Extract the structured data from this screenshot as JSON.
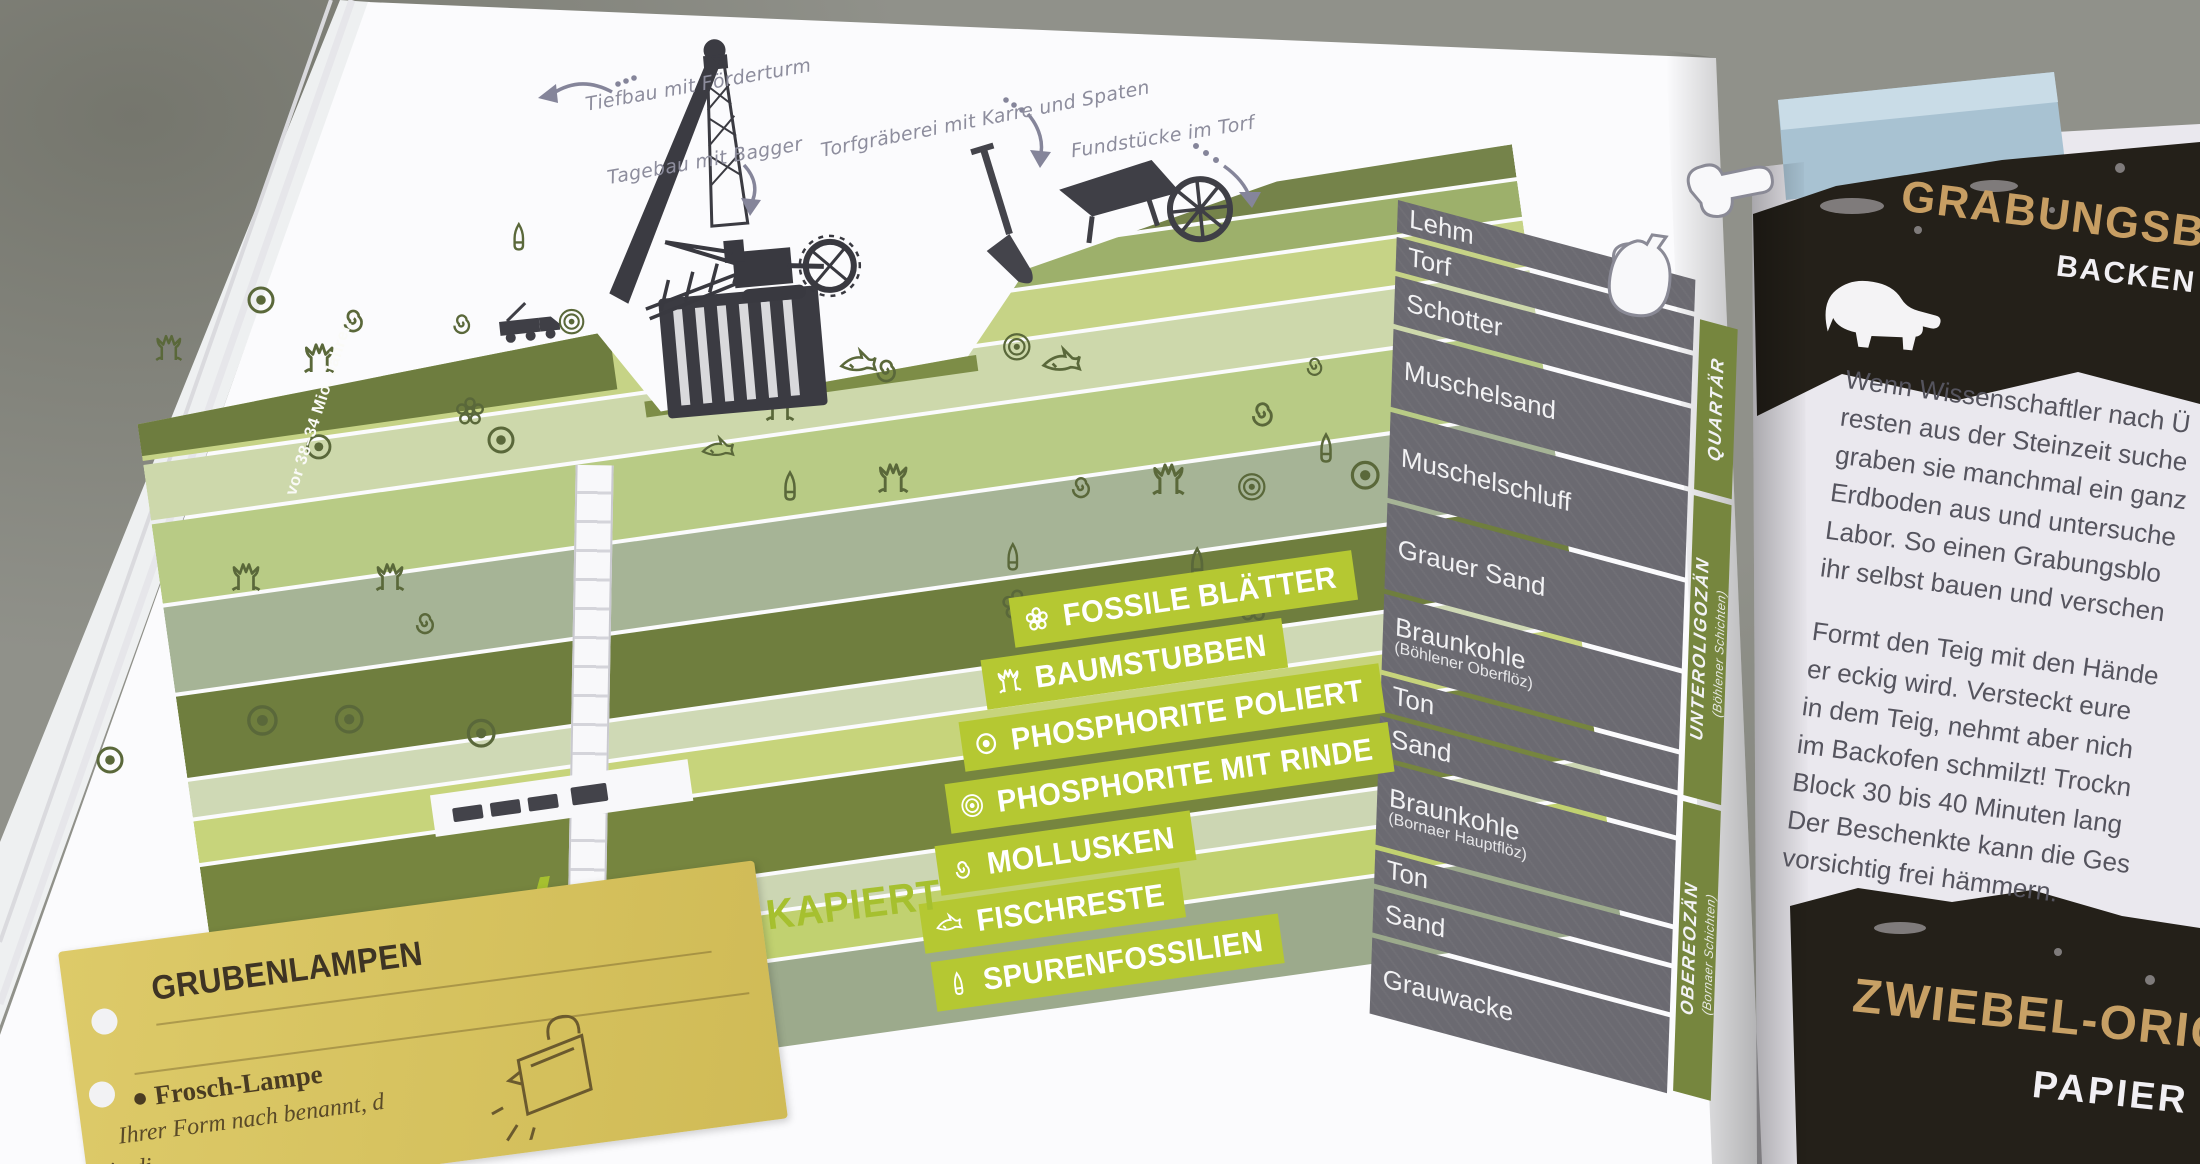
{
  "colors": {
    "accent_lime": "#b5c832",
    "column_gray": "#6b6a71",
    "era_olive": "#76863e",
    "card_yellow": "#d9c464",
    "title_tan": "#c7a065"
  },
  "page_left": {
    "annotations": {
      "tiefbau": "Tiefbau mit Förderturm",
      "tagebau": "Tagebau mit Bagger",
      "torfgraeberei": "Torfgräberei mit Karre und Spaten",
      "fundstuecke": "Fundstücke im Torf"
    },
    "era_note": "vor 38–34 Mio. Jahren",
    "strat_column": {
      "layers": [
        {
          "name": "Lehm",
          "sub": ""
        },
        {
          "name": "Torf",
          "sub": ""
        },
        {
          "name": "Schotter",
          "sub": ""
        },
        {
          "name": "Muschelsand",
          "sub": ""
        },
        {
          "name": "Muschelschluff",
          "sub": ""
        },
        {
          "name": "Grauer Sand",
          "sub": ""
        },
        {
          "name": "Braunkohle",
          "sub": "(Böhlener Oberflöz)"
        },
        {
          "name": "Ton",
          "sub": ""
        },
        {
          "name": "Sand",
          "sub": ""
        },
        {
          "name": "Braunkohle",
          "sub": "(Bornaer Hauptflöz)"
        },
        {
          "name": "Ton",
          "sub": ""
        },
        {
          "name": "Sand",
          "sub": ""
        },
        {
          "name": "Grauwacke",
          "sub": ""
        }
      ],
      "eras": [
        {
          "name": "QUARTÄR",
          "sub": ""
        },
        {
          "name": "UNTEROLIGOZÄN",
          "sub": "(Böhlener Schichten)"
        },
        {
          "name": "OBEREOZÄN",
          "sub": "(Bornaer Schichten)"
        }
      ]
    },
    "legend": {
      "items": [
        {
          "icon": "flower-icon",
          "label": "FOSSILE BLÄTTER"
        },
        {
          "icon": "stump-icon",
          "label": "BAUMSTUBBEN"
        },
        {
          "icon": "phosphorite-polished-icon",
          "label": "PHOSPHORITE POLIERT"
        },
        {
          "icon": "phosphorite-rind-icon",
          "label": "PHOSPHORITE MIT RINDE"
        },
        {
          "icon": "mollusk-icon",
          "label": "MOLLUSKEN"
        },
        {
          "icon": "fish-icon",
          "label": "FISCHRESTE"
        },
        {
          "icon": "trace-fossil-icon",
          "label": "SPURENFOSSILIEN"
        }
      ]
    },
    "quick_tip": {
      "label": "SCHNELL KAPIERT"
    },
    "card": {
      "title": "GRUBENLAMPEN",
      "bullet": "●",
      "item_title": "Frosch-Lampe",
      "lines": [
        "Ihrer Form nach benannt, d",
        "in di"
      ]
    }
  },
  "page_right": {
    "top_card": {
      "title": "GRABUNGSBLOC",
      "subtitle": "BACKEN"
    },
    "body": {
      "p1": [
        "Wenn Wissenschaftler nach Ü",
        "resten aus der Steinzeit suche",
        "graben sie manchmal ein ganz",
        "Erdboden aus und untersuche",
        "Labor. So einen Grabungsblo",
        "ihr selbst bauen und verschen"
      ],
      "p2": [
        "Formt den Teig mit den Hände",
        "er eckig wird. Versteckt eure",
        "in dem Teig, nehmt aber nich",
        "im Backofen schmilzt! Trockn",
        "Block 30 bis 40 Minuten lang",
        "Der Beschenkte kann die Ges",
        "vorsichtig frei hämmern."
      ]
    },
    "bottom_card": {
      "title": "ZWIEBEL-ORIG",
      "subtitle": "PAPIER"
    }
  }
}
